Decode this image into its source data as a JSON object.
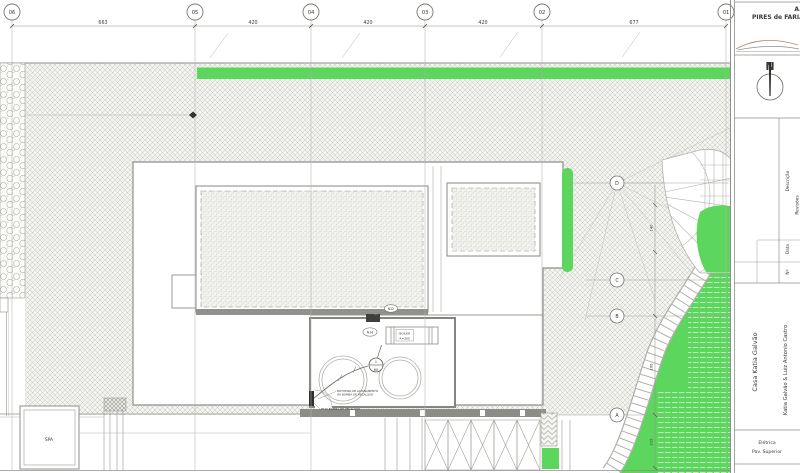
{
  "title_block": {
    "company_line1": "A.A",
    "company_line2": "PIRES de FARIA",
    "north_label": "N",
    "revisions": {
      "col_no": "Nº",
      "col_date": "Data",
      "col_desc": "Descrição",
      "title": "Revisões"
    },
    "project_name": "Casa Katia Galvão",
    "client": "Katia Galvão & Luiz Antonio Castro",
    "sheet_line1": "Elétrica",
    "sheet_line2": "Pav. Superior"
  },
  "grid": {
    "cols": [
      "06",
      "05",
      "04",
      "03",
      "02",
      "01"
    ],
    "rows": [
      "D",
      "C",
      "B",
      "A"
    ],
    "dims": [
      "663",
      "420",
      "420",
      "420",
      "677"
    ]
  },
  "annotations": {
    "spa": "SPA",
    "boiler_line1": "BOILER",
    "boiler_line2": "R=300",
    "tag_top": "N12",
    "tag_boiler": "N14",
    "outlet_circuit": "1",
    "outlet_height": "60",
    "note1_line1": "BOTOEIRA DE ACIONAMENTO",
    "note1_line2": "DA BOMBA DE RECALQUE",
    "note2": "PT P/ BOMBA DE RECALQUE",
    "dim_a": "140",
    "dim_b": "166",
    "dim_c": "215"
  },
  "colors": {
    "grass_green": "#5cd65c",
    "paper": "#ffffff",
    "line_gray": "#8f8f8c"
  }
}
